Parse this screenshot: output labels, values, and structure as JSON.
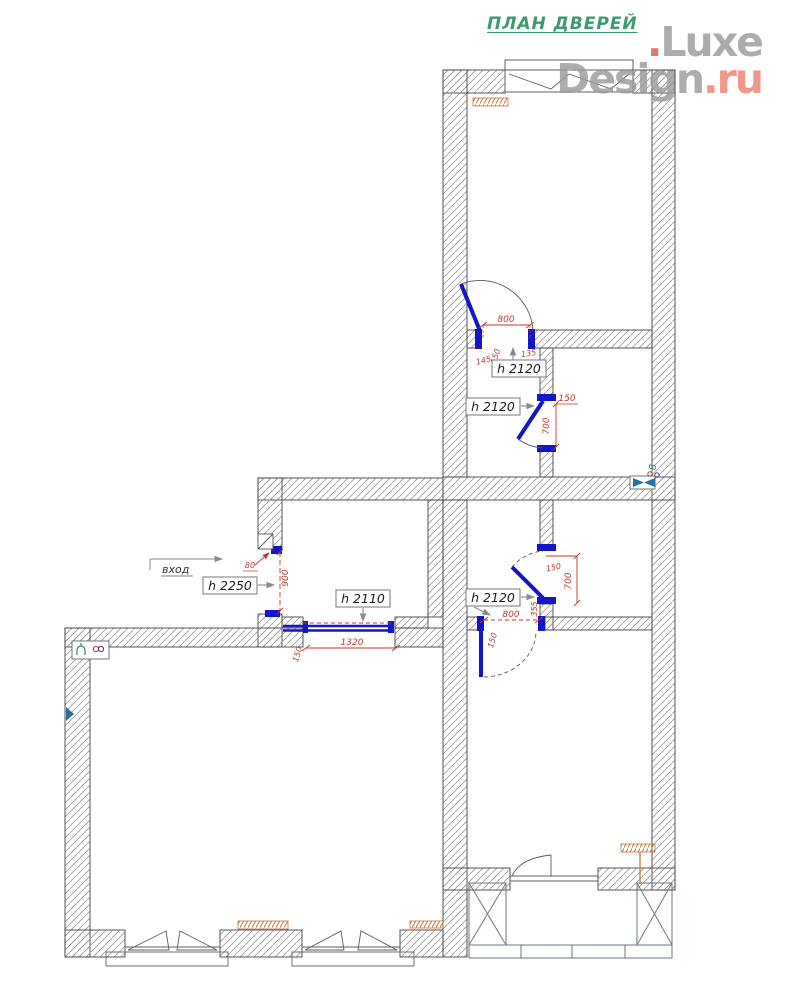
{
  "title": "ПЛАН ДВЕРЕЙ",
  "logo": {
    "dot": ".",
    "name_top": "Luxe",
    "name_bottom": "Design",
    "domain": ".ru"
  },
  "entrance_label": "вход",
  "heights": {
    "door_top": "h 2120",
    "door_corridor": "h 2120",
    "door_hall": "h 2120",
    "entrance": "h 2250",
    "portal": "h 2110"
  },
  "dims": {
    "door_top_width": "800",
    "door_top_off_left": "145",
    "door_top_off_mid": "150",
    "door_top_off_right": "135",
    "door_corridor_off": "150",
    "door_corridor_width": "700",
    "door_hall_off": "150",
    "door_hall_width": "700",
    "door_hall_jamb": "355",
    "door_room_width": "800",
    "door_room_off": "150",
    "entrance_off": "80",
    "entrance_width": "900",
    "portal_width": "1320",
    "portal_off": "150"
  },
  "symbols": {
    "vent_label": "8"
  },
  "colors": {
    "wall_outline": "#444444",
    "hatch": "#9a9a9a",
    "door_blue": "#1515c8",
    "dimension_red": "#c0392b",
    "title_green": "#3d9970",
    "logo_gray": "#9b9b9b",
    "logo_red": "#ec8075",
    "radiator_orange": "#c4763a"
  }
}
